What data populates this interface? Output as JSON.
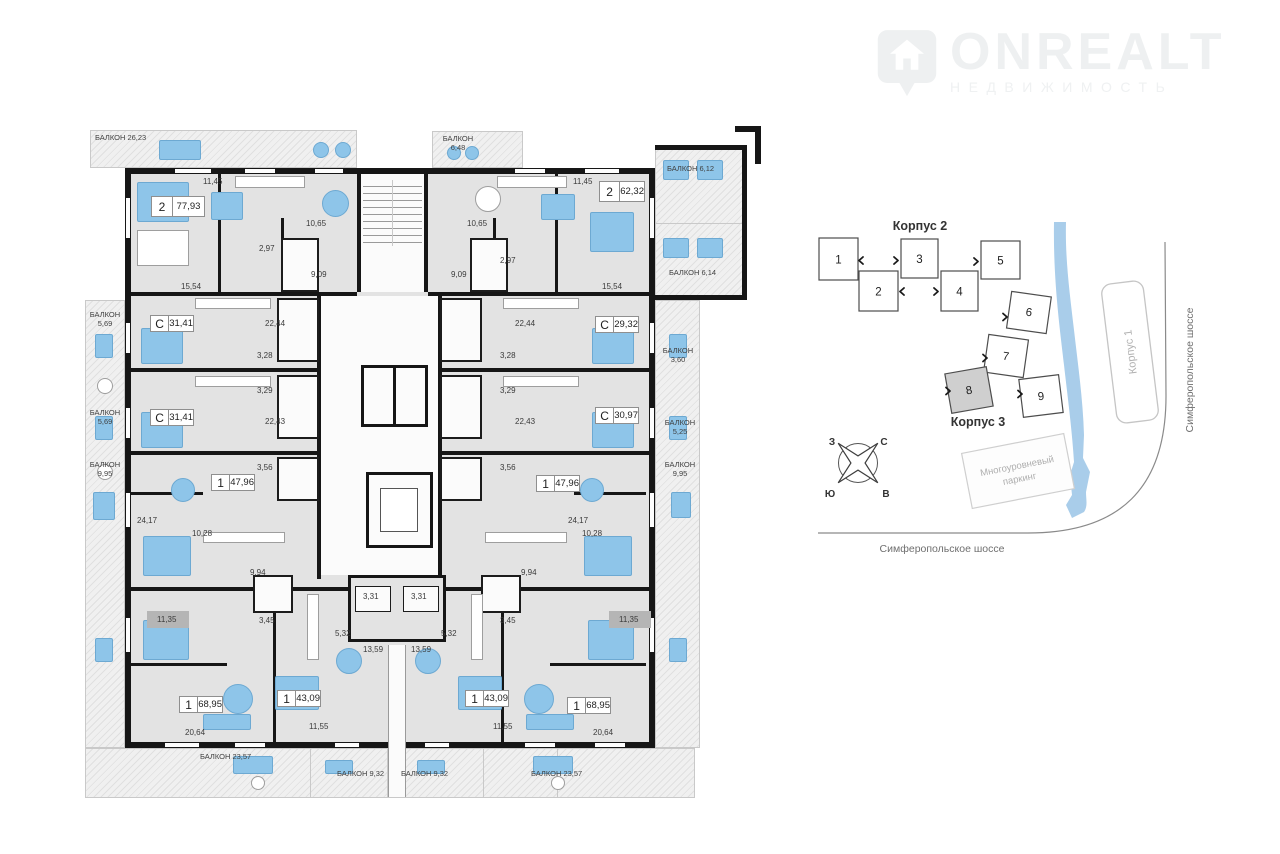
{
  "logo": {
    "brand": "ONREALT",
    "subtitle": "НЕДВИЖИМОСТЬ"
  },
  "floorplan": {
    "apartments": [
      {
        "type": "2",
        "area": "77,93"
      },
      {
        "type": "2",
        "area": "62,32"
      },
      {
        "type": "С",
        "area": "31,41"
      },
      {
        "type": "С",
        "area": "29,32"
      },
      {
        "type": "С",
        "area": "31,41"
      },
      {
        "type": "С",
        "area": "30,97"
      },
      {
        "type": "1",
        "area": "47,96"
      },
      {
        "type": "1",
        "area": "47,96"
      },
      {
        "type": "1",
        "area": "68,95"
      },
      {
        "type": "1",
        "area": "43,09"
      },
      {
        "type": "1",
        "area": "43,09"
      },
      {
        "type": "1",
        "area": "68,95"
      }
    ],
    "balconies": [
      "БАЛКОН 26,23",
      "БАЛКОН 6,48",
      "БАЛКОН 6,12",
      "БАЛКОН 6,14",
      "БАЛКОН 5,69",
      "БАЛКОН 5,69",
      "БАЛКОН 9,95",
      "БАЛКОН 3,60",
      "БАЛКОН 5,25",
      "БАЛКОН 9,95",
      "БАЛКОН 23,57",
      "БАЛКОН 9,32",
      "БАЛКОН 9,32",
      "БАЛКОН 23,57"
    ],
    "dims": [
      "11,45",
      "10,65",
      "2,97",
      "9,09",
      "15,54",
      "22,44",
      "3,28",
      "3,29",
      "22,43",
      "3,56",
      "24,17",
      "10,28",
      "9,94",
      "3,45",
      "11,35",
      "3,31",
      "5,32",
      "13,59",
      "11,55",
      "20,64"
    ]
  },
  "siteplan": {
    "korpus2_label": "Корпус 2",
    "korpus3_label": "Корпус 3",
    "korpus1_label": "Корпус 1",
    "blocks": [
      "1",
      "2",
      "3",
      "4",
      "5",
      "6",
      "7",
      "8",
      "9"
    ],
    "highlighted_block": "8",
    "parking_line1": "Многоуровневый",
    "parking_line2": "паркинг",
    "street_bottom": "Симферопольское шоссе",
    "street_right": "Симферопольское шоссе",
    "compass": {
      "w": "З",
      "n": "С",
      "s": "Ю",
      "e": "В"
    }
  },
  "colors": {
    "furniture_blue": "#8ec5e9",
    "river_blue": "#a9cdea",
    "wall_black": "#161616",
    "floor_gray": "#e3e3e3",
    "highlight_gray": "#cfcfcf"
  }
}
